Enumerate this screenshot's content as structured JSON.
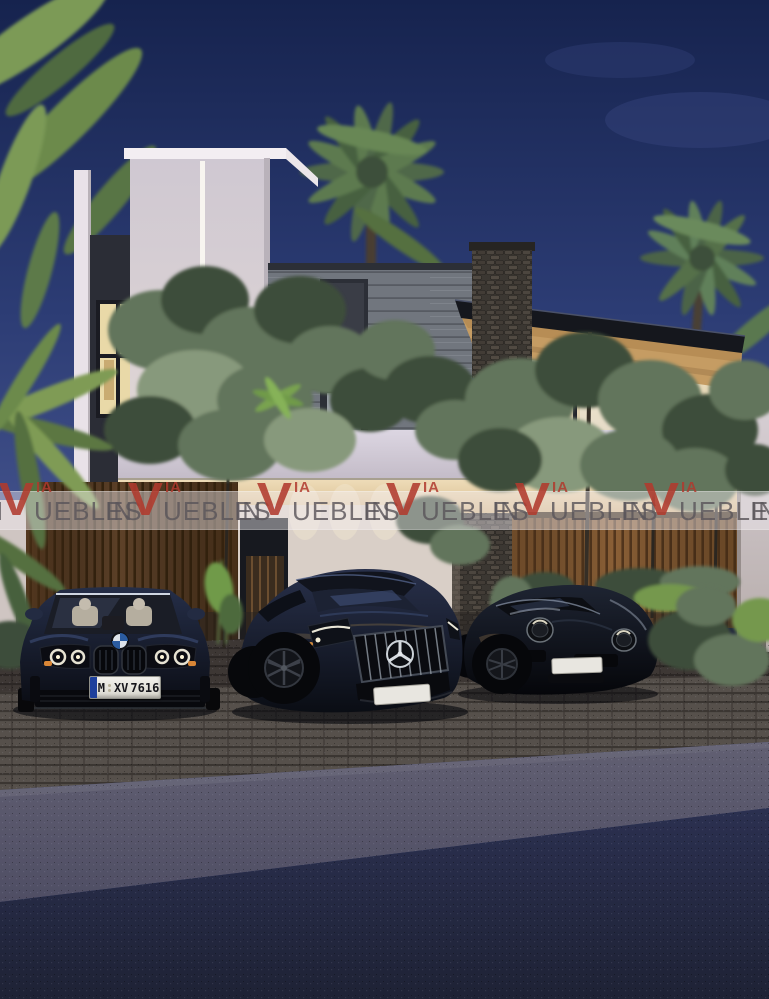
{
  "scene": {
    "caption": "Modern two-storey tropical residence at dusk with three black luxury cars parked in front",
    "sky": "deep blue dusk, palm trees"
  },
  "watermark": {
    "brand": "VIA",
    "full_text": "INMUEBLES",
    "prefix": "IN",
    "v": "V",
    "brand_tail": "IA",
    "suffix": "UEBLES",
    "color": "#b03a2e",
    "repeats": 6
  },
  "license_plate": {
    "full": "M XV 7616",
    "city": "M",
    "letters": "XV",
    "numbers": "7616",
    "band_color": "#1d3f9c"
  },
  "cars": [
    {
      "position": "left",
      "emblem": "BMW roundel",
      "body_color": "#10141f",
      "plate": "M XV 7616"
    },
    {
      "position": "center",
      "emblem": "Mercedes-Benz star",
      "body_color": "#0d1118",
      "plate": ""
    },
    {
      "position": "right",
      "emblem": "Porsche 911",
      "body_color": "#07090c",
      "plate": ""
    }
  ],
  "palette": {
    "sky_top": "#16234e",
    "sky_bottom": "#45548e",
    "wall_white": "#ddd5dc",
    "glass_glow": "#f0e2c2",
    "soffit_wood": "#c59c63",
    "wood_warm": "#8a5f36",
    "wood_dark": "#54391f",
    "stone": "#3b3732",
    "foliage_dark": "#3d4e3a",
    "foliage_light": "#87997c",
    "paver": "#56504b",
    "asphalt_light": "#595868",
    "asphalt_dark": "#252a41",
    "watermark_red": "#b03a2e"
  }
}
